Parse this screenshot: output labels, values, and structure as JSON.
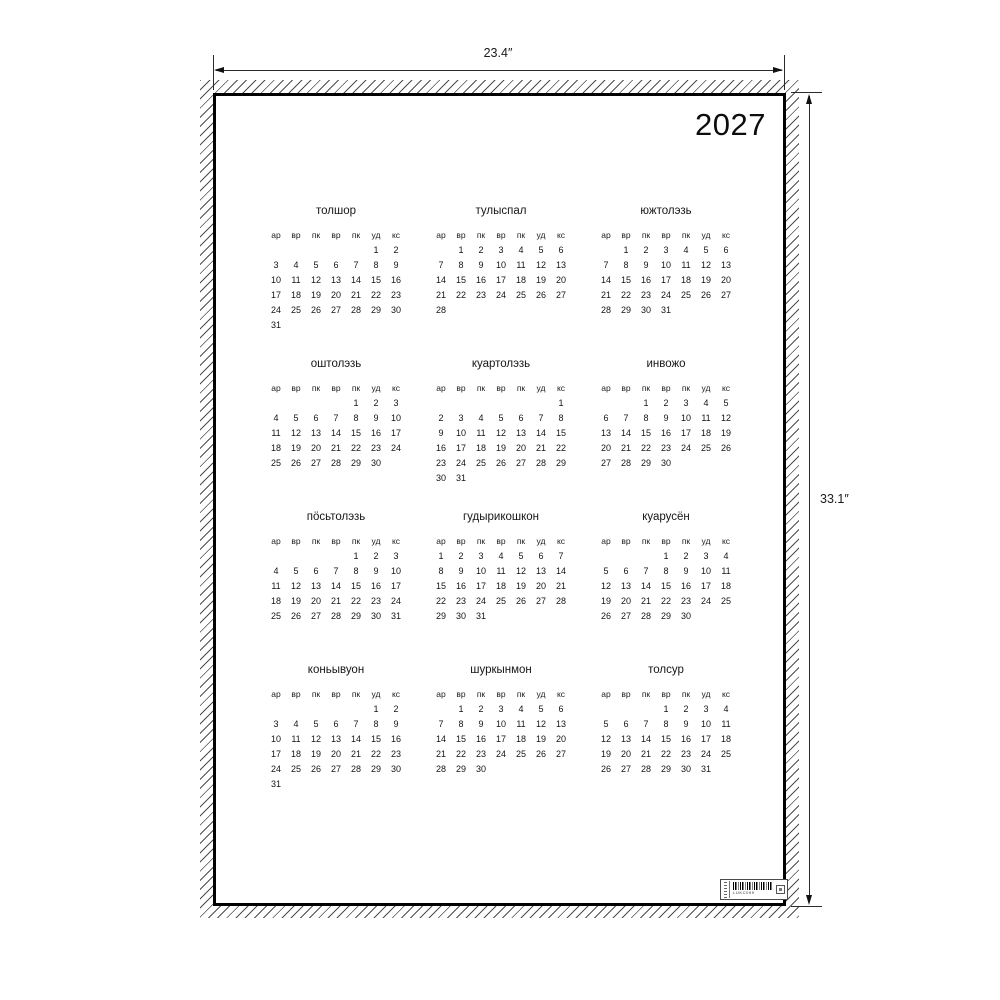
{
  "year": "2027",
  "dimensions": {
    "width_label": "23.4″",
    "height_label": "33.1″"
  },
  "day_headers": [
    "ар",
    "вр",
    "пк",
    "вр",
    "пк",
    "уд",
    "кс"
  ],
  "months": [
    {
      "name": "толшор",
      "weeks": [
        [
          "",
          "",
          "",
          "",
          "",
          "1",
          "2"
        ],
        [
          "3",
          "4",
          "5",
          "6",
          "7",
          "8",
          "9"
        ],
        [
          "10",
          "11",
          "12",
          "13",
          "14",
          "15",
          "16"
        ],
        [
          "17",
          "18",
          "19",
          "20",
          "21",
          "22",
          "23"
        ],
        [
          "24",
          "25",
          "26",
          "27",
          "28",
          "29",
          "30"
        ],
        [
          "31",
          "",
          "",
          "",
          "",
          "",
          ""
        ]
      ]
    },
    {
      "name": "тулыспал",
      "weeks": [
        [
          "",
          "1",
          "2",
          "3",
          "4",
          "5",
          "6"
        ],
        [
          "7",
          "8",
          "9",
          "10",
          "11",
          "12",
          "13"
        ],
        [
          "14",
          "15",
          "16",
          "17",
          "18",
          "19",
          "20"
        ],
        [
          "21",
          "22",
          "23",
          "24",
          "25",
          "26",
          "27"
        ],
        [
          "28",
          "",
          "",
          "",
          "",
          "",
          ""
        ]
      ]
    },
    {
      "name": "южтолэзь",
      "weeks": [
        [
          "",
          "1",
          "2",
          "3",
          "4",
          "5",
          "6"
        ],
        [
          "7",
          "8",
          "9",
          "10",
          "11",
          "12",
          "13"
        ],
        [
          "14",
          "15",
          "16",
          "17",
          "18",
          "19",
          "20"
        ],
        [
          "21",
          "22",
          "23",
          "24",
          "25",
          "26",
          "27"
        ],
        [
          "28",
          "29",
          "30",
          "31",
          "",
          "",
          ""
        ]
      ]
    },
    {
      "name": "оштолэзь",
      "weeks": [
        [
          "",
          "",
          "",
          "",
          "1",
          "2",
          "3"
        ],
        [
          "4",
          "5",
          "6",
          "7",
          "8",
          "9",
          "10"
        ],
        [
          "11",
          "12",
          "13",
          "14",
          "15",
          "16",
          "17"
        ],
        [
          "18",
          "19",
          "20",
          "21",
          "22",
          "23",
          "24"
        ],
        [
          "25",
          "26",
          "27",
          "28",
          "29",
          "30",
          ""
        ]
      ]
    },
    {
      "name": "куартолэзь",
      "weeks": [
        [
          "",
          "",
          "",
          "",
          "",
          "",
          "1"
        ],
        [
          "2",
          "3",
          "4",
          "5",
          "6",
          "7",
          "8"
        ],
        [
          "9",
          "10",
          "11",
          "12",
          "13",
          "14",
          "15"
        ],
        [
          "16",
          "17",
          "18",
          "19",
          "20",
          "21",
          "22"
        ],
        [
          "23",
          "24",
          "25",
          "26",
          "27",
          "28",
          "29"
        ],
        [
          "30",
          "31",
          "",
          "",
          "",
          "",
          ""
        ]
      ]
    },
    {
      "name": "инвожо",
      "weeks": [
        [
          "",
          "",
          "1",
          "2",
          "3",
          "4",
          "5"
        ],
        [
          "6",
          "7",
          "8",
          "9",
          "10",
          "11",
          "12"
        ],
        [
          "13",
          "14",
          "15",
          "16",
          "17",
          "18",
          "19"
        ],
        [
          "20",
          "21",
          "22",
          "23",
          "24",
          "25",
          "26"
        ],
        [
          "27",
          "28",
          "29",
          "30",
          "",
          "",
          ""
        ]
      ]
    },
    {
      "name": "пӧсьтолэзь",
      "weeks": [
        [
          "",
          "",
          "",
          "",
          "1",
          "2",
          "3"
        ],
        [
          "4",
          "5",
          "6",
          "7",
          "8",
          "9",
          "10"
        ],
        [
          "11",
          "12",
          "13",
          "14",
          "15",
          "16",
          "17"
        ],
        [
          "18",
          "19",
          "20",
          "21",
          "22",
          "23",
          "24"
        ],
        [
          "25",
          "26",
          "27",
          "28",
          "29",
          "30",
          "31"
        ]
      ]
    },
    {
      "name": "гудырикошкон",
      "weeks": [
        [
          "1",
          "2",
          "3",
          "4",
          "5",
          "6",
          "7"
        ],
        [
          "8",
          "9",
          "10",
          "11",
          "12",
          "13",
          "14"
        ],
        [
          "15",
          "16",
          "17",
          "18",
          "19",
          "20",
          "21"
        ],
        [
          "22",
          "23",
          "24",
          "25",
          "26",
          "27",
          "28"
        ],
        [
          "29",
          "30",
          "31",
          "",
          "",
          "",
          ""
        ]
      ]
    },
    {
      "name": "куарусён",
      "weeks": [
        [
          "",
          "",
          "",
          "1",
          "2",
          "3",
          "4"
        ],
        [
          "5",
          "6",
          "7",
          "8",
          "9",
          "10",
          "11"
        ],
        [
          "12",
          "13",
          "14",
          "15",
          "16",
          "17",
          "18"
        ],
        [
          "19",
          "20",
          "21",
          "22",
          "23",
          "24",
          "25"
        ],
        [
          "26",
          "27",
          "28",
          "29",
          "30",
          "",
          ""
        ]
      ]
    },
    {
      "name": "коньывуон",
      "weeks": [
        [
          "",
          "",
          "",
          "",
          "",
          "1",
          "2"
        ],
        [
          "3",
          "4",
          "5",
          "6",
          "7",
          "8",
          "9"
        ],
        [
          "10",
          "11",
          "12",
          "13",
          "14",
          "15",
          "16"
        ],
        [
          "17",
          "18",
          "19",
          "20",
          "21",
          "22",
          "23"
        ],
        [
          "24",
          "25",
          "26",
          "27",
          "28",
          "29",
          "30"
        ],
        [
          "31",
          "",
          "",
          "",
          "",
          "",
          ""
        ]
      ]
    },
    {
      "name": "шуркынмон",
      "weeks": [
        [
          "",
          "1",
          "2",
          "3",
          "4",
          "5",
          "6"
        ],
        [
          "7",
          "8",
          "9",
          "10",
          "11",
          "12",
          "13"
        ],
        [
          "14",
          "15",
          "16",
          "17",
          "18",
          "19",
          "20"
        ],
        [
          "21",
          "22",
          "23",
          "24",
          "25",
          "26",
          "27"
        ],
        [
          "28",
          "29",
          "30",
          "",
          "",
          "",
          ""
        ]
      ]
    },
    {
      "name": "толсур",
      "weeks": [
        [
          "",
          "",
          "",
          "1",
          "2",
          "3",
          "4"
        ],
        [
          "5",
          "6",
          "7",
          "8",
          "9",
          "10",
          "11"
        ],
        [
          "12",
          "13",
          "14",
          "15",
          "16",
          "17",
          "18"
        ],
        [
          "19",
          "20",
          "21",
          "22",
          "23",
          "24",
          "25"
        ],
        [
          "26",
          "27",
          "28",
          "29",
          "30",
          "31",
          ""
        ]
      ]
    }
  ],
  "barcode": {
    "text": "LUKC099"
  }
}
